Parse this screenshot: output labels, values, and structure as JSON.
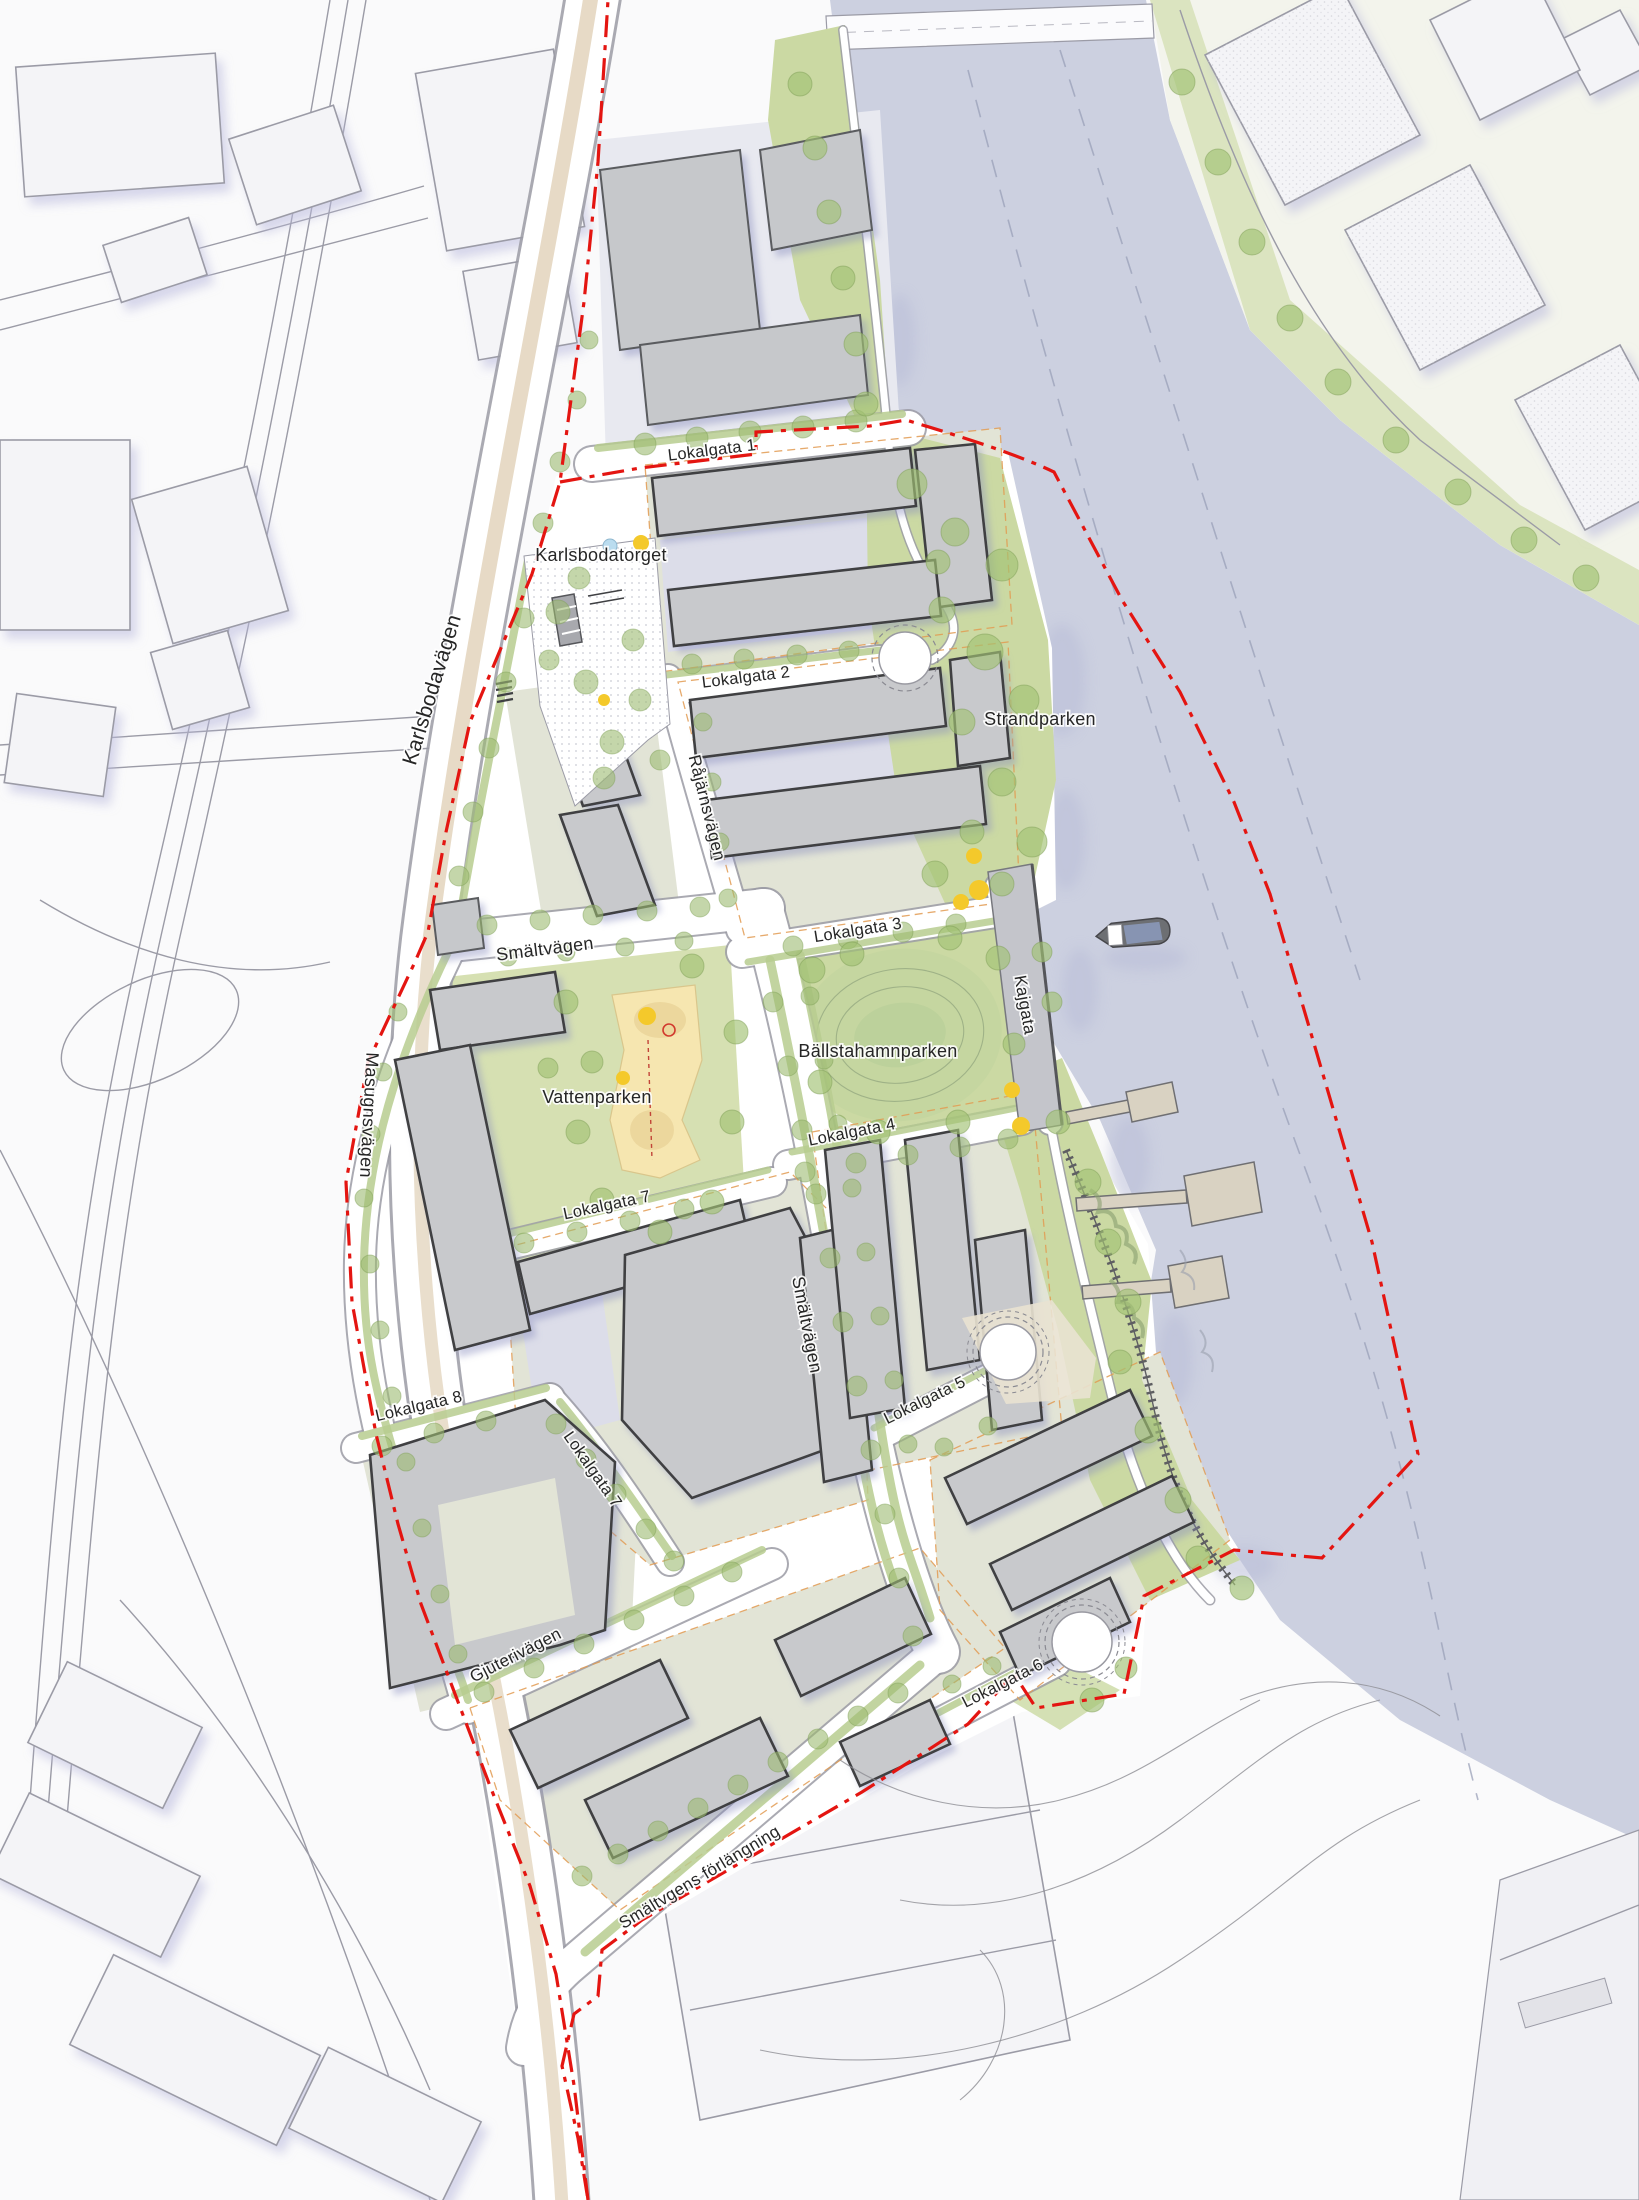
{
  "labels": {
    "karlsbodavagen": "Karlsbodavägen",
    "masugnsvagen": "Masugnsvägen",
    "rajarnsvagen": "Råjärnsvägen",
    "smaltvagen_north": "Smältvägen",
    "smaltvagen_south": "Smältvägen",
    "smaltvagens_forlangning": "Smältvgens förlängning",
    "gjuterivagen": "Gjuterivägen",
    "kajgata": "Kajgata",
    "lokalgata_1": "Lokalgata 1",
    "lokalgata_2": "Lokalgata 2",
    "lokalgata_3": "Lokalgata 3",
    "lokalgata_4": "Lokalgata 4",
    "lokalgata_5": "Lokalgata 5",
    "lokalgata_6": "Lokalgata 6",
    "lokalgata_7": "Lokalgata 7",
    "lokalgata_8": "Lokalgata 8",
    "karlsbodatorget": "Karlsbodatorget",
    "strandparken": "Strandparken",
    "ballstahamnparken": "Bällstahamnparken",
    "vattenparken": "Vattenparken"
  },
  "colors": {
    "context_bg": "#fafafb",
    "context_fill": "#f4f4f7",
    "context_line": "#9b9ba6",
    "context_shadow": "#c9c9e4",
    "water": "#ccd0e0",
    "water_dash": "#99a0b8",
    "park_green": "#cbd9a3",
    "park_green_light": "#d6e0b2",
    "verge_green": "#b7cd8f",
    "tree_green": "#9dbb72",
    "block_courtyard": "#e2e4d6",
    "block_paving": "#dcdde9",
    "building_fill": "#c8c9cc",
    "building_outline": "#3f4043",
    "existing_building_fill": "#c6c8cb",
    "street_white": "#ffffff",
    "tram_beige": "#e7dac6",
    "sand": "#f6e6b0",
    "sand_dark": "#ecd79d",
    "boundary_red": "#e41511",
    "orange_guide": "#e29b52",
    "label_ink": "#262626",
    "yellow_play": "#f4c92b",
    "pond_blue": "#badcef",
    "boat_hull": "#6d6f73",
    "boat_deck": "#8794b2",
    "pier_fill": "#d9d2c2",
    "pier_stroke": "#6f6f72"
  }
}
